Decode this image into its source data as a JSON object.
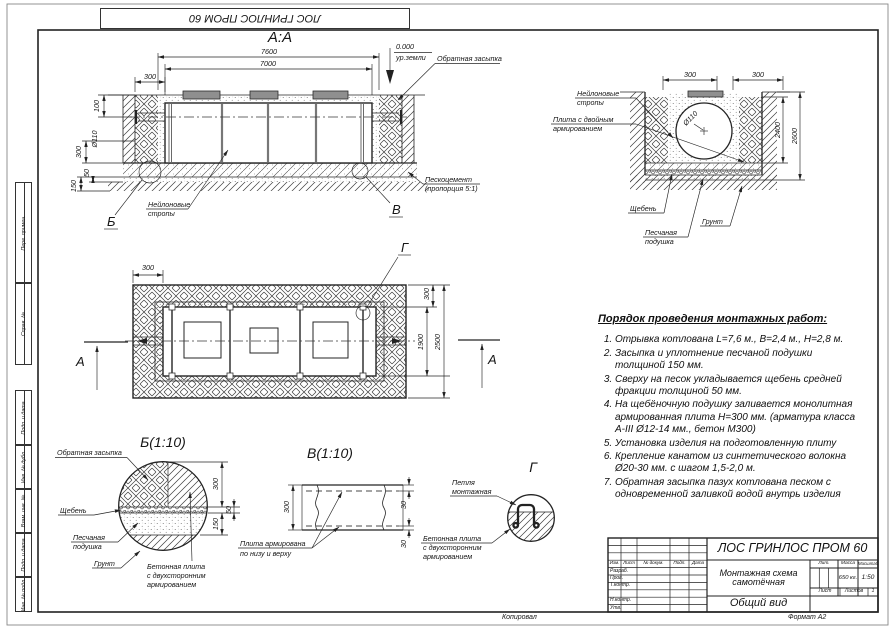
{
  "colors": {
    "line": "#2b2b2b",
    "lid_fill": "#8f8f8f",
    "paper": "#ffffff"
  },
  "sheet": {
    "top_stamp": "ЛОС ГРИНЛОС ПРОМ 60",
    "side_fields": [
      "Перв. примен.",
      "Справ. №",
      "Подп. и дата",
      "Инв. № дубл.",
      "Взам. инв. №",
      "Подп. и дата",
      "Инв. № подл."
    ],
    "footer_copied": "Копировал",
    "footer_format": "Формат А2"
  },
  "section_aa": {
    "title": "А:А",
    "dims": {
      "w_outer": "7600",
      "w_inner": "7000",
      "wall": "300",
      "inlet": "100",
      "pipe": "Ø110",
      "slab": "300",
      "sand": "150",
      "gravel": "50"
    },
    "level": {
      "zero": "0.000",
      "ground": "ур.земли"
    },
    "labels": {
      "backfill": "Обратная засыпка",
      "sandcement_1": "Пескоцемент",
      "sandcement_2": "(пропорция 5:1)",
      "slings_1": "Нейлоновые",
      "slings_2": "стропы"
    },
    "callout_b": "Б",
    "callout_v": "В"
  },
  "cross_section": {
    "dims": {
      "left": "300",
      "right": "300",
      "inner": "2400",
      "outer": "2600",
      "pipe": "Ø110"
    },
    "labels": {
      "slings_1": "Нейлоновые",
      "slings_2": "стропы",
      "plate_1": "Плита с двойным",
      "plate_2": "армированием",
      "gravel": "Щебень",
      "soil": "Грунт",
      "sand_1": "Песчаная",
      "sand_2": "подушка"
    }
  },
  "plan": {
    "dims": {
      "top": "300",
      "right": "300",
      "inner": "1900",
      "outer": "2500"
    },
    "callout_g": "Г",
    "section_mark": "А"
  },
  "detail_b": {
    "title": "Б(1:10)",
    "dims": {
      "plate": "300",
      "sand": "150",
      "gravel": "50"
    },
    "labels": {
      "backfill": "Обратная засыпка",
      "gravel": "Щебень",
      "sand_1": "Песчаная",
      "sand_2": "подушка",
      "soil": "Грунт",
      "plate_1": "Бетонная плита",
      "plate_2": "с двухсторонним",
      "plate_3": "армированием"
    }
  },
  "detail_v": {
    "title": "В(1:10)",
    "dims": {
      "total": "300",
      "top": "30",
      "bottom": "30"
    },
    "labels": {
      "line_1": "Плита армирована",
      "line_2": "по низу и верху"
    }
  },
  "detail_g": {
    "title": "Г",
    "labels": {
      "loop_1": "Петля",
      "loop_2": "монтажная",
      "plate_1": "Бетонная плита",
      "plate_2": "с двухсторонним",
      "plate_3": "армированием"
    }
  },
  "instructions": {
    "title": "Порядок проведения монтажных работ:",
    "items": [
      "Отрывка котлована L=7,6 м., В=2,4 м., Н=2,8 м.",
      "Засыпка и уплотнение песчаной подушки толщиной 150 мм.",
      "Сверху на песок укладывается щебень средней фракции толщиной 50 мм.",
      "На щебёночную подушку заливается монолитная армированная плита Н=300 мм. (арматура класса А-III Ø12-14 мм., бетон М300)",
      "Установка изделия на подготовленную плиту",
      "Крепление канатом из синтетического волокна Ø20-30 мм. с шагом 1,5-2,0 м.",
      "Обратная засыпка пазух котлована песком с одновременной заливкой водой внутрь изделия"
    ]
  },
  "title_block": {
    "product": "ЛОС ГРИНЛОС ПРОМ 60",
    "doc_name": "Монтажная схема самотёчная",
    "view_name": "Общий вид",
    "columns": {
      "izm": "Изм.",
      "list": "Лист",
      "doc": "№ докум.",
      "podp": "Подп.",
      "data": "Дата"
    },
    "rows": {
      "razrab": "Разраб.",
      "prov": "Пров.",
      "tkontr": "Т.контр.",
      "nkontr": "Н.контр.",
      "utv": "Утв."
    },
    "lit": "Лит.",
    "mass": "Масса",
    "scale": "Масштаб",
    "mass_value": "650 кг.",
    "scale_value": "1:50",
    "sheet": "Лист",
    "sheets": "Листов",
    "sheets_value": "1"
  }
}
